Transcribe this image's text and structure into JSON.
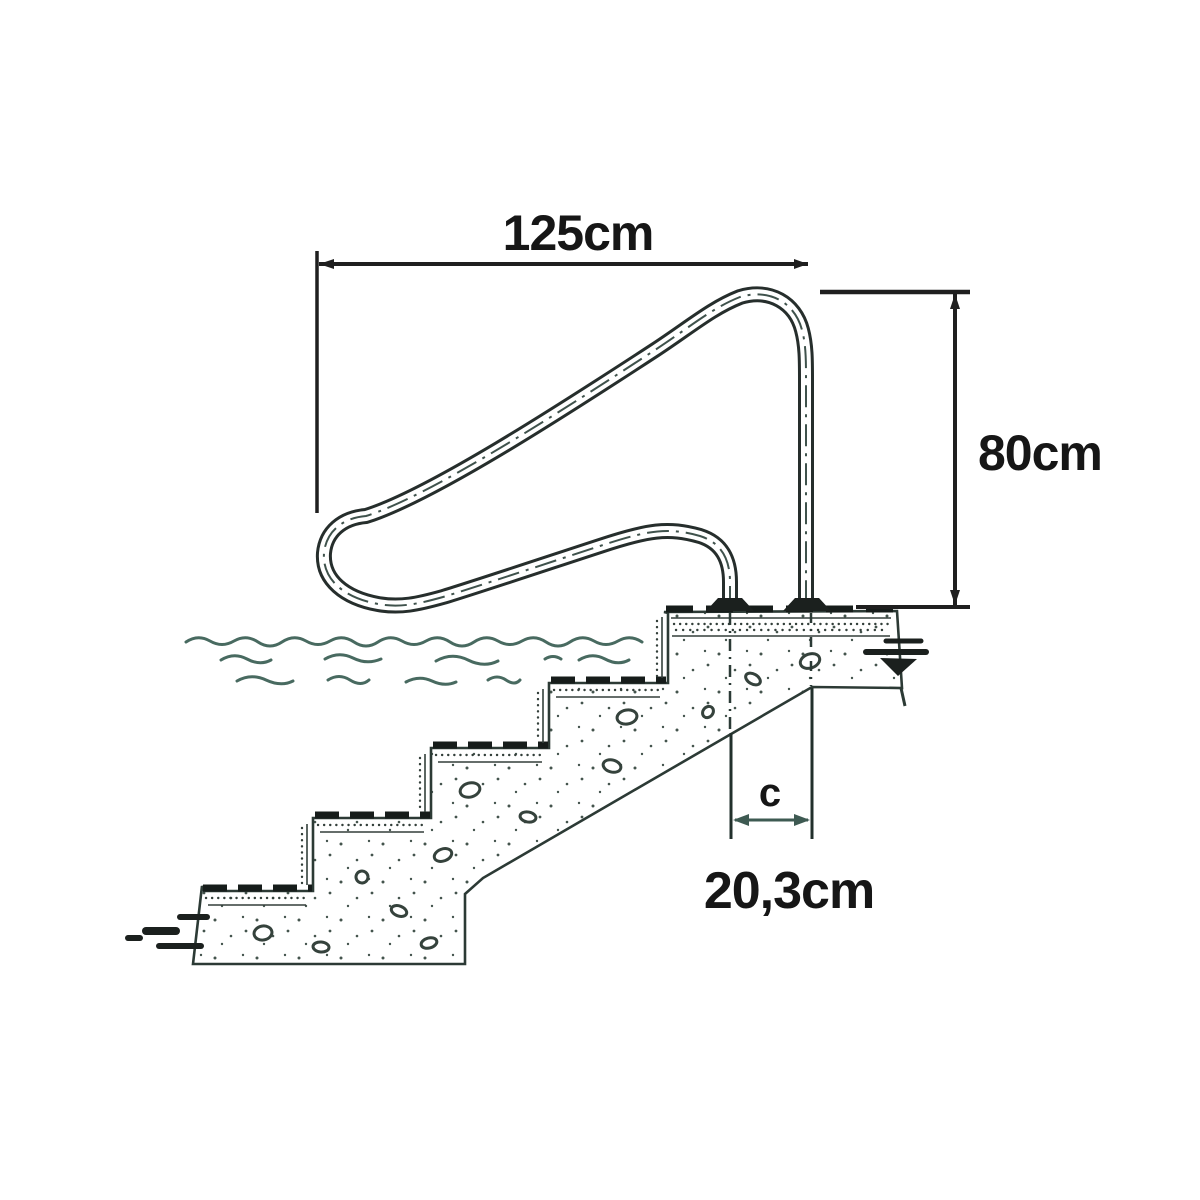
{
  "figure": {
    "type": "technical-diagram",
    "subject": "pool handrail mounted on concrete steps (section view)",
    "dimensions": {
      "rail_span_label": "125cm",
      "rail_height_label": "80cm",
      "anchor_spacing_symbol": "c",
      "anchor_spacing_value": "20,3cm"
    },
    "colors": {
      "background": "#ffffff",
      "ink": "#1b201e",
      "teal_line": "#486a60",
      "text": "#141414"
    }
  }
}
